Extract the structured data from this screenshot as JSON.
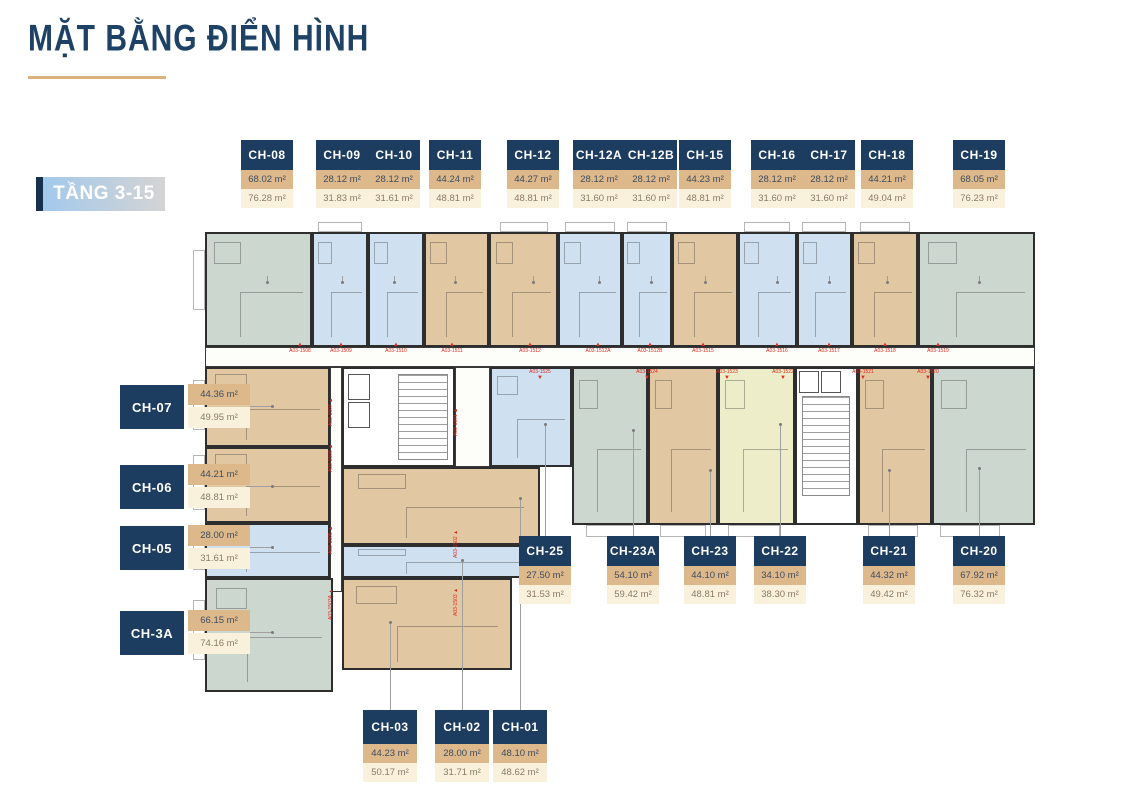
{
  "header": {
    "title": "MẶT BẰNG ĐIỂN HÌNH",
    "floor_badge": "TẦNG 3-15"
  },
  "colors": {
    "navy": "#1d3d60",
    "title_navy": "#1e4266",
    "gold": "#dcb27a",
    "tan_box": "#dcb88b",
    "cream_box": "#faf1dd",
    "area1_text": "#3e4d5f",
    "area2_text": "#8a7b64",
    "unit_blue": "#cfe0f0",
    "unit_tan": "#e2c7a3",
    "unit_sage": "#ccd7d0",
    "unit_yellow": "#ededc9",
    "marker_red": "#df2b1e",
    "badge_grad_from": "#a3c9ec",
    "badge_grad_to": "#d4d4d4",
    "badge_bar": "#17304d"
  },
  "unit_groups": [
    {
      "id": "top",
      "layout": "stack",
      "card": {
        "w": 52,
        "y": 140,
        "name_h": 30,
        "row_h": 19,
        "line_from": 208
      },
      "units": [
        {
          "name": "CH-08",
          "area1": "68.02 m²",
          "area2": "76.28 m²",
          "color": "sage",
          "cx": 267,
          "rect": [
            205,
            232,
            107,
            115
          ],
          "line_end": 282
        },
        {
          "name": "CH-09",
          "area1": "28.12 m²",
          "area2": "31.83 m²",
          "color": "blue",
          "cx": 342,
          "rect": [
            312,
            232,
            56,
            115
          ],
          "line_end": 282
        },
        {
          "name": "CH-10",
          "area1": "28.12 m²",
          "area2": "31.61 m²",
          "color": "blue",
          "cx": 394,
          "rect": [
            368,
            232,
            56,
            115
          ],
          "line_end": 282
        },
        {
          "name": "CH-11",
          "area1": "44.24 m²",
          "area2": "48.81 m²",
          "color": "tan",
          "cx": 455,
          "rect": [
            424,
            232,
            65,
            115
          ],
          "line_end": 282
        },
        {
          "name": "CH-12",
          "area1": "44.27 m²",
          "area2": "48.81 m²",
          "color": "tan",
          "cx": 533,
          "rect": [
            489,
            232,
            69,
            115
          ],
          "line_end": 282
        },
        {
          "name": "CH-12A",
          "area1": "28.12 m²",
          "area2": "31.60 m²",
          "color": "blue",
          "cx": 599,
          "rect": [
            558,
            232,
            64,
            115
          ],
          "line_end": 282
        },
        {
          "name": "CH-12B",
          "area1": "28.12 m²",
          "area2": "31.60 m²",
          "color": "blue",
          "cx": 651,
          "rect": [
            622,
            232,
            50,
            115
          ],
          "line_end": 282
        },
        {
          "name": "CH-15",
          "area1": "44.23 m²",
          "area2": "48.81 m²",
          "color": "tan",
          "cx": 705,
          "rect": [
            672,
            232,
            66,
            115
          ],
          "line_end": 282
        },
        {
          "name": "CH-16",
          "area1": "28.12 m²",
          "area2": "31.60 m²",
          "color": "blue",
          "cx": 777,
          "rect": [
            738,
            232,
            59,
            115
          ],
          "line_end": 282
        },
        {
          "name": "CH-17",
          "area1": "28.12 m²",
          "area2": "31.60 m²",
          "color": "blue",
          "cx": 829,
          "rect": [
            797,
            232,
            55,
            115
          ],
          "line_end": 282
        },
        {
          "name": "CH-18",
          "area1": "44.21 m²",
          "area2": "49.04 m²",
          "color": "tan",
          "cx": 887,
          "rect": [
            852,
            232,
            66,
            115
          ],
          "line_end": 282
        },
        {
          "name": "CH-19",
          "area1": "68.05 m²",
          "area2": "76.23 m²",
          "color": "sage",
          "cx": 979,
          "rect": [
            918,
            232,
            117,
            115
          ],
          "line_end": 282
        }
      ]
    },
    {
      "id": "left",
      "layout": "side",
      "units": [
        {
          "name": "CH-07",
          "area1": "44.36 m²",
          "area2": "49.95 m²",
          "color": "tan",
          "cy": 407,
          "rect": [
            205,
            367,
            125,
            80
          ],
          "line_end": 272
        },
        {
          "name": "CH-06",
          "area1": "44.21 m²",
          "area2": "48.81 m²",
          "color": "tan",
          "cy": 487,
          "rect": [
            205,
            447,
            125,
            76
          ],
          "line_end": 272
        },
        {
          "name": "CH-05",
          "area1": "28.00 m²",
          "area2": "31.61 m²",
          "color": "blue",
          "cy": 548,
          "rect": [
            205,
            523,
            125,
            55
          ],
          "line_end": 272
        },
        {
          "name": "CH-3A",
          "area1": "66.15 m²",
          "area2": "74.16 m²",
          "color": "sage",
          "cy": 633,
          "rect": [
            205,
            578,
            128,
            114
          ],
          "line_end": 272
        }
      ]
    },
    {
      "id": "bottom-mid",
      "layout": "stack",
      "card": {
        "w": 52,
        "y": 536,
        "name_h": 30,
        "row_h": 19,
        "line_from": 536
      },
      "units": [
        {
          "name": "CH-25",
          "area1": "27.50 m²",
          "area2": "31.53 m²",
          "color": "blue",
          "cx": 545,
          "rect": [
            490,
            367,
            82,
            100
          ],
          "line_end": 424
        },
        {
          "name": "CH-23A",
          "area1": "54.10 m²",
          "area2": "59.42 m²",
          "color": "sage",
          "cx": 633,
          "rect": [
            572,
            367,
            76,
            158
          ],
          "line_end": 430
        },
        {
          "name": "CH-23",
          "area1": "44.10 m²",
          "area2": "48.81 m²",
          "color": "tan",
          "cx": 710,
          "rect": [
            648,
            367,
            70,
            158
          ],
          "line_end": 470
        },
        {
          "name": "CH-22",
          "area1": "34.10 m²",
          "area2": "38.30 m²",
          "color": "yellow",
          "cx": 780,
          "rect": [
            718,
            367,
            77,
            158
          ],
          "line_end": 424
        },
        {
          "name": "CH-21",
          "area1": "44.32 m²",
          "area2": "49.42 m²",
          "color": "tan",
          "cx": 889,
          "rect": [
            858,
            367,
            74,
            158
          ],
          "line_end": 470
        },
        {
          "name": "CH-20",
          "area1": "67.92 m²",
          "area2": "76.32 m²",
          "color": "sage",
          "cx": 979,
          "rect": [
            932,
            367,
            103,
            158
          ],
          "line_end": 468
        }
      ]
    },
    {
      "id": "bottom-low",
      "layout": "stack",
      "card": {
        "w": 54,
        "y": 710,
        "name_h": 34,
        "row_h": 19,
        "line_from": 710
      },
      "units": [
        {
          "name": "CH-03",
          "area1": "44.23 m²",
          "area2": "50.17 m²",
          "color": "tan",
          "cx": 390,
          "rect": [
            342,
            578,
            170,
            92
          ],
          "line_end": 622
        },
        {
          "name": "CH-02",
          "area1": "28.00 m²",
          "area2": "31.71 m²",
          "color": "blue",
          "cx": 462,
          "rect": [
            342,
            545,
            198,
            33
          ],
          "line_end": 560
        },
        {
          "name": "CH-01",
          "area1": "48.10 m²",
          "area2": "48.62 m²",
          "color": "tan",
          "cx": 520,
          "rect": [
            342,
            467,
            198,
            78
          ],
          "line_end": 498
        }
      ]
    }
  ],
  "plan": {
    "balconies": [
      [
        318,
        222,
        44,
        10
      ],
      [
        500,
        222,
        48,
        10
      ],
      [
        565,
        222,
        50,
        10
      ],
      [
        627,
        222,
        40,
        10
      ],
      [
        744,
        222,
        46,
        10
      ],
      [
        802,
        222,
        44,
        10
      ],
      [
        860,
        222,
        50,
        10
      ],
      [
        586,
        525,
        48,
        12
      ],
      [
        660,
        525,
        46,
        12
      ],
      [
        728,
        525,
        52,
        12
      ],
      [
        868,
        525,
        50,
        12
      ],
      [
        940,
        525,
        60,
        12
      ],
      [
        505,
        457,
        50,
        10
      ],
      [
        193,
        250,
        12,
        60
      ],
      [
        193,
        380,
        12,
        50
      ],
      [
        193,
        455,
        12,
        55
      ],
      [
        193,
        530,
        12,
        40
      ],
      [
        193,
        600,
        12,
        60
      ]
    ],
    "lift_glyph": "✕",
    "markers": {
      "top": [
        {
          "text": "A03-1508",
          "x": 300
        },
        {
          "text": "A03-1509",
          "x": 341
        },
        {
          "text": "A03-1510",
          "x": 396
        },
        {
          "text": "A03-1511",
          "x": 452
        },
        {
          "text": "A03-1512",
          "x": 530
        },
        {
          "text": "A03-1512A",
          "x": 598
        },
        {
          "text": "A03-1512B",
          "x": 650
        },
        {
          "text": "A03-1515",
          "x": 703
        },
        {
          "text": "A03-1516",
          "x": 777
        },
        {
          "text": "A03-1517",
          "x": 829
        },
        {
          "text": "A03-1518",
          "x": 885
        },
        {
          "text": "A03-1519",
          "x": 938
        }
      ],
      "bottom": [
        {
          "text": "A03-1525",
          "x": 540
        },
        {
          "text": "A03-1524",
          "x": 647
        },
        {
          "text": "A03-1523",
          "x": 727
        },
        {
          "text": "A03-1522",
          "x": 783
        },
        {
          "text": "A03-1521",
          "x": 863
        },
        {
          "text": "A03-1520",
          "x": 928
        }
      ],
      "side": [
        {
          "text": "A03-1507",
          "x": 334,
          "y": 420
        },
        {
          "text": "A03-1506",
          "x": 334,
          "y": 466
        },
        {
          "text": "A03-1505",
          "x": 334,
          "y": 548
        },
        {
          "text": "A03-1503A",
          "x": 334,
          "y": 614
        },
        {
          "text": "A03-1501",
          "x": 459,
          "y": 430
        },
        {
          "text": "A03-1502",
          "x": 459,
          "y": 552
        },
        {
          "text": "A03-1503",
          "x": 459,
          "y": 610
        }
      ]
    }
  }
}
